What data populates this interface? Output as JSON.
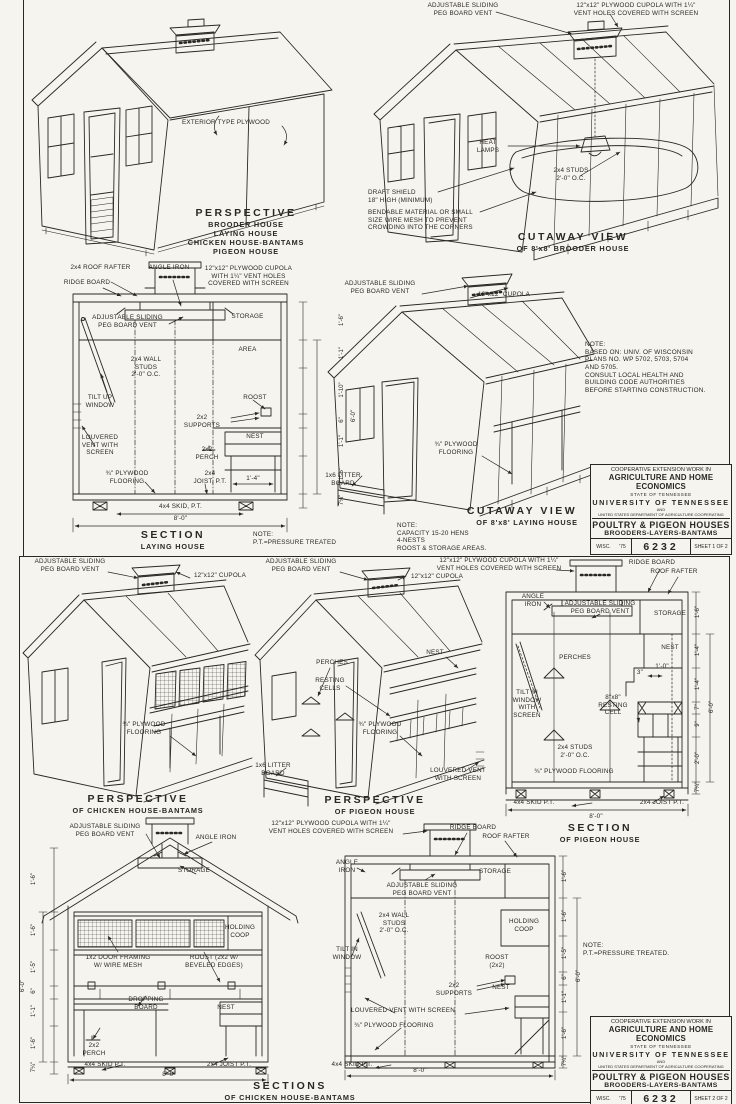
{
  "ink": "#2a2823",
  "paper": "#f6f4ee",
  "s1": {
    "persp": {
      "plywood": "EXTERIOR TYPE PLYWOOD",
      "title": "PERSPECTIVE",
      "sub": "BROODER HOUSE\nLAYING HOUSE\nCHICKEN HOUSE-BANTAMS\nPIGEON HOUSE"
    },
    "cutb": {
      "vent": "ADJUSTABLE SLIDING\nPEG BOARD VENT",
      "cupola": "12\"x12\" PLYWOOD CUPOLA WITH 1¼\"\nVENT HOLES COVERED WITH SCREEN",
      "heat": "HEAT\nLAMPS",
      "studs": "2x4 STUDS\n2'-0\" O.C.",
      "draft": "DRAFT SHIELD\n18\" HIGH (MINIMUM)",
      "bend": "BENDABLE MATERIAL OR SMALL\nSIZE WIRE MESH TO PREVENT\nCROWDING INTO THE CORNERS",
      "title": "CUTAWAY VIEW",
      "sub": "OF 8'x8' BROODER HOUSE"
    },
    "secl": {
      "rafter": "2x4 ROOF RAFTER",
      "angle": "ANGLE IRON",
      "cupola": "12\"x12\" PLYWOOD CUPOLA\nWITH 1¼\" VENT HOLES\nCOVERED WITH SCREEN",
      "ridge": "RIDGE BOARD",
      "vent": "ADJUSTABLE SLIDING\nPEG BOARD VENT",
      "storage": "STORAGE",
      "area": "AREA",
      "studs": "2x4 WALL\nSTUDS\n2'-0\" O.C.",
      "tilt": "TILT UP\nWINDOW",
      "roost": "ROOST",
      "supports": "2x2\nSUPPORTS",
      "louver": "LOUVERED\nVENT WITH\nSCREEN",
      "nest": "NEST",
      "perch": "2x2\nPERCH",
      "floor": "¾\" PLYWOOD\nFLOORING",
      "joist": "2x4\nJOIST, P.T.",
      "nestw": "1'-4\"",
      "skid": "4x4 SKID, P.T.",
      "width": "8'-0\"",
      "dims": [
        "1'-6\"",
        "1'-1\"",
        "1'-10\"",
        "6\"",
        "1'-1\"",
        "1'-6\"",
        "7¼\""
      ],
      "height": "6'-0\"",
      "title": "SECTION",
      "sub": "LAYING HOUSE",
      "note": "NOTE:\nP.T.=PRESSURE TREATED"
    },
    "cutl": {
      "vent": "ADJUSTABLE SLIDING\nPEG BOARD VENT",
      "cupola": "12\"x12\" CUPOLA",
      "floor": "¾\" PLYWOOD\nFLOORING",
      "litter": "1x6 LITTER\nBOARD",
      "title": "CUTAWAY VIEW",
      "sub": "OF 8'x8' LAYING HOUSE",
      "note": "NOTE:\nCAPACITY 15-20 HENS\n4-NESTS\nROOST & STORAGE AREAS."
    },
    "wisc": "NOTE:\nBASED ON: UNIV. OF WISCONSIN\nPLANS NO. WP 5702, 5703, 5704\nAND 5705.\nCONSULT LOCAL HEALTH AND\nBUILDING CODE AUTHORITIES\nBEFORE STARTING CONSTRUCTION."
  },
  "s2": {
    "pc": {
      "vent": "ADJUSTABLE SLIDING\nPEG BOARD VENT",
      "cupola": "12\"x12\" CUPOLA",
      "floor": "¾\" PLYWOOD\nFLOORING",
      "title": "PERSPECTIVE",
      "sub": "OF CHICKEN HOUSE-BANTAMS"
    },
    "pp": {
      "vent": "ADJUSTABLE SLIDING\nPEG BOARD VENT",
      "cupola": "12\"x12\" CUPOLA",
      "perches": "PERCHES",
      "cells": "RESTING\nCELLS",
      "nest": "NEST",
      "floor": "¾\" PLYWOOD\nFLOORING",
      "litter": "1x6 LITTER\nBOARD",
      "louver": "LOUVERED VENT\nWITH SCREEN",
      "title": "PERSPECTIVE",
      "sub": "OF PIGEON HOUSE"
    },
    "sp": {
      "cupola": "12\"x12\" PLYWOOD CUPOLA WITH 1¼\"\nVENT HOLES COVERED WITH SCREEN",
      "ridge": "RIDGE BOARD",
      "rafter": "ROOF RAFTER",
      "angle": "ANGLE\nIRON",
      "vent": "ADJUSTABLE SLIDING\nPEG BOARD VENT",
      "storage": "STORAGE",
      "nest": "NEST",
      "perches": "PERCHES",
      "d3": "3\"",
      "d10": "1'-0\"",
      "tilt": "TILT IN\nWINDOW\nWITH\nSCREEN",
      "cell": "8\"x8\"\nRESTING\nCELL",
      "studs": "2x4 STUDS\n2'-0\" O.C.",
      "floor": "¾\" PLYWOOD FLOORING",
      "skid": "4x4 SKID P.T.",
      "joist": "2x4 JOIST P.T.",
      "width": "8'-0\"",
      "dims": [
        "1'-6\"",
        "1'-4\"",
        "1'-4\"",
        "7\"",
        "9\"",
        "2'-0\"",
        "7¼\""
      ],
      "height": "6'-0\"",
      "title": "SECTION",
      "sub": "OF PIGEON HOUSE"
    },
    "sca": {
      "vent": "ADJUSTABLE SLIDING\nPEG BOARD VENT",
      "angle": "ANGLE IRON",
      "storage": "STORAGE",
      "coop": "HOLDING\nCOOP",
      "framing": "1x2 DOOR FRAMING\nW/ WIRE MESH",
      "roost": "ROOST (2x2 W/\nBEVELED EDGES)",
      "dropping": "DROPPING\nBOARD",
      "nest": "NEST",
      "perch": "2x2\nPERCH",
      "skid": "4x4 SKID P.T.",
      "joist": "2x4 JOIST P.T.",
      "width": "8'-0\"",
      "dims": [
        "1'-6\"",
        "1'-6\"",
        "1'-5\"",
        "6\"",
        "1'-1\"",
        "1'-6\"",
        "7¼\""
      ],
      "height": "6'-0\""
    },
    "scb": {
      "cupola": "12\"x12\" PLYWOOD CUPOLA WITH 1¼\"\nVENT HOLES COVERED WITH SCREEN",
      "ridge": "RIDGE BOARD",
      "rafter": "ROOF RAFTER",
      "angle": "ANGLE\nIRON",
      "vent": "ADJUSTABLE SLIDING\nPEG BOARD VENT",
      "storage": "STORAGE",
      "coop": "HOLDING\nCOOP",
      "studs": "2x4 WALL\nSTUDS\n2'-0\" O.C.",
      "tilt": "TILT IN\nWINDOW",
      "roost": "ROOST\n(2x2)",
      "supports": "2x2\nSUPPORTS",
      "nest": "NEST",
      "louver": "LOUVERED VENT WITH SCREEN",
      "floor": "¾\" PLYWOOD FLOORING",
      "skid": "4x4 SKID P.T.",
      "width": "8'-0\"",
      "dims": [
        "1'-6\"",
        "1'-6\"",
        "1'-5\"",
        "6\"",
        "1'-1\"",
        "1'-6\"",
        "7¼\""
      ],
      "height": "6'-0\""
    },
    "note": "NOTE:\nP.T.=PRESSURE TREATED.",
    "ftitle": "SECTIONS",
    "fsub": "OF CHICKEN HOUSE-BANTAMS"
  },
  "tb": {
    "l1": "COOPERATIVE EXTENSION WORK IN",
    "l2": "AGRICULTURE AND HOME ECONOMICS",
    "l3": "STATE OF TENNESSEE",
    "l4": "UNIVERSITY OF TENNESSEE",
    "l5": "AND",
    "l6": "UNITED STATES DEPARTMENT OF AGRICULTURE COOPERATING",
    "l7": "POULTRY & PIGEON HOUSES",
    "l8": "BROODERS-LAYERS-BANTAMS",
    "agency": "WISC.",
    "year": "'75",
    "num": "6232",
    "sheet1": "SHEET 1 OF 2",
    "sheet2": "SHEET 2 OF 2"
  }
}
